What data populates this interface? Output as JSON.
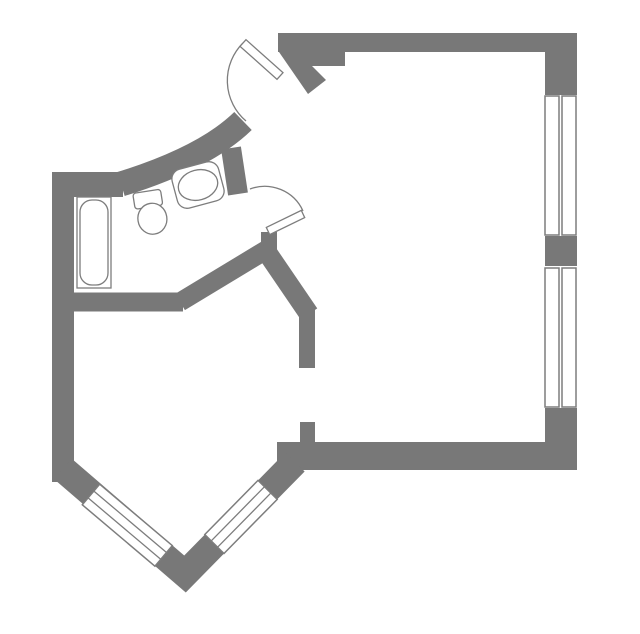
{
  "canvas": {
    "w": 640,
    "h": 634,
    "bg": "#ffffff"
  },
  "colors": {
    "wall": "#787878",
    "line": "#7d7d7d",
    "fill": "#ffffff"
  },
  "plan": {
    "walls": {
      "rects": [
        {
          "name": "outer-wall-top",
          "x": 278,
          "y": 33,
          "w": 299,
          "h": 19
        },
        {
          "name": "outer-wall-top-step",
          "x": 290,
          "y": 52,
          "w": 55,
          "h": 14
        },
        {
          "name": "outer-wall-right-upper",
          "x": 545,
          "y": 33,
          "w": 32,
          "h": 64
        },
        {
          "name": "outer-wall-right-mid",
          "x": 545,
          "y": 235,
          "w": 32,
          "h": 31
        },
        {
          "name": "outer-wall-right-lower",
          "x": 545,
          "y": 407,
          "w": 32,
          "h": 63
        },
        {
          "name": "outer-wall-bottom",
          "x": 277,
          "y": 442,
          "w": 300,
          "h": 28
        },
        {
          "name": "doorway-stub",
          "x": 300,
          "y": 422,
          "w": 15,
          "h": 20
        },
        {
          "name": "partition-wall-vertical",
          "x": 299,
          "y": 308,
          "w": 16,
          "h": 60
        },
        {
          "name": "outer-wall-left",
          "x": 52,
          "y": 172,
          "w": 22,
          "h": 310
        },
        {
          "name": "bathroom-wall-top",
          "x": 52,
          "y": 172,
          "w": 71,
          "h": 25
        },
        {
          "name": "junction-stub",
          "x": 261,
          "y": 232,
          "w": 16,
          "h": 30
        }
      ],
      "polys": [
        {
          "name": "entrance-jamb",
          "points": [
            [
              279,
              52
            ],
            [
              298,
              52
            ],
            [
              326,
              80
            ],
            [
              308,
              94
            ]
          ]
        }
      ],
      "strokes": [
        {
          "name": "corridor-curved-wall",
          "d": "M 121,184 Q 205,158 243,121",
          "w": 25
        },
        {
          "name": "bathroom-door-post",
          "d": "M 231,148 L 238,194",
          "w": 20
        },
        {
          "name": "bathroom-wall-bottom",
          "d": "M 70,302 L 183,302",
          "w": 19
        },
        {
          "name": "bathroom-wall-diagonal",
          "d": "M 180,302 L 266,250",
          "w": 19
        },
        {
          "name": "hall-wall-diagonal",
          "d": "M 264,248 L 309,314",
          "w": 20
        },
        {
          "name": "bay-wall",
          "d": "M 63,469 L 185,574 L 295,462",
          "w": 27
        }
      ]
    },
    "windows": {
      "straight": [
        {
          "name": "right-window-upper",
          "bg": [
            543,
            95,
            36,
            141
          ],
          "frames": [
            [
              545,
              96,
              14,
              139
            ],
            [
              562,
              96,
              14,
              139
            ]
          ]
        },
        {
          "name": "right-window-lower",
          "bg": [
            543,
            267,
            36,
            141
          ],
          "frames": [
            [
              545,
              268,
              14,
              139
            ],
            [
              562,
              268,
              14,
              139
            ]
          ]
        }
      ],
      "angled": [
        {
          "name": "bay-window-left",
          "band": [
            [
              99.7,
              484.2
            ],
            [
              172.3,
              545.6
            ],
            [
              154.9,
              566.2
            ],
            [
              82.3,
              504.8
            ]
          ],
          "lines": [
            [
              93.9,
              491.1,
              166.5,
              552.5
            ],
            [
              88.1,
              497.9,
              160.7,
              559.3
            ]
          ]
        },
        {
          "name": "bay-window-right",
          "band": [
            [
              224.0,
              553.5
            ],
            [
              277.2,
              499.4
            ],
            [
              258.0,
              480.4
            ],
            [
              204.8,
              534.5
            ]
          ],
          "lines": [
            [
              217.6,
              547.2,
              270.8,
              493.1
            ],
            [
              211.2,
              540.9,
              264.4,
              486.8
            ]
          ]
        }
      ]
    },
    "doors": [
      {
        "name": "entrance-door",
        "leaf": [
          [
            246,
            39.7
          ],
          [
            283,
            72.7
          ],
          [
            277,
            79.3
          ],
          [
            240,
            46.3
          ]
        ],
        "arc": "M 243,43 A 53,53 0 0 0 246,121"
      },
      {
        "name": "bathroom-door",
        "leaf": [
          [
            266.3,
            227.4
          ],
          [
            301.3,
            210.4
          ],
          [
            304.7,
            217.6
          ],
          [
            269.7,
            234.6
          ]
        ],
        "arc": "M 303,211 A 42,42 0 0 0 250,189"
      }
    ],
    "fixtures": {
      "bathtub": {
        "outer": [
          77,
          197,
          34,
          91
        ],
        "inner": [
          80,
          200,
          28,
          85
        ],
        "inner_rx": 12
      },
      "toilet": {
        "rotate": [
          -9,
          150,
          210
        ],
        "tank": [
          135.5,
          191,
          28,
          16,
          3
        ],
        "bowl": [
          151,
          219,
          14.5,
          15.5
        ]
      },
      "sink": {
        "rotate": [
          -15,
          198,
          185
        ],
        "body": [
          174,
          165,
          48,
          40,
          10
        ],
        "basin": [
          198,
          185,
          20,
          15
        ]
      }
    }
  }
}
